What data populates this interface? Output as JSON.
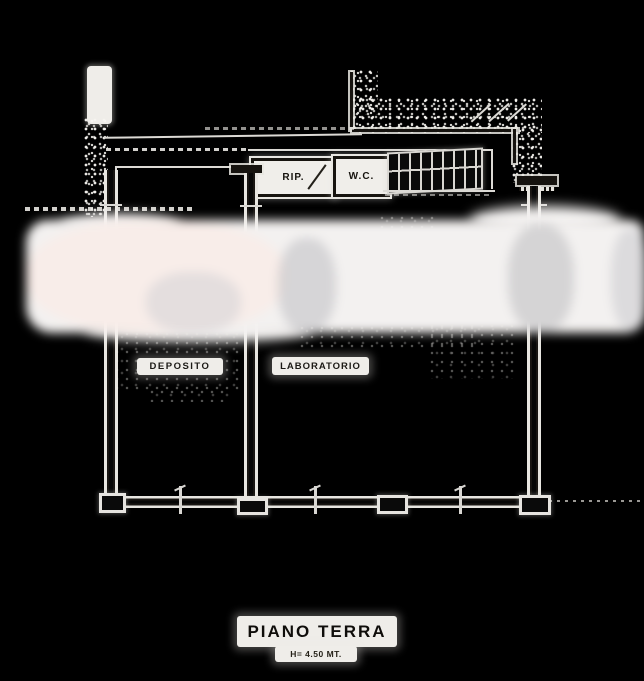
{
  "plan": {
    "rooms": {
      "rip": {
        "label": "RIP."
      },
      "wc": {
        "label": "W.C."
      },
      "deposito": {
        "label": "DEPOSITO"
      },
      "laboratorio": {
        "label": "LABORATORIO"
      }
    },
    "footer": {
      "title": "PIANO TERRA",
      "height_note": "H= 4.50 MT."
    },
    "colors": {
      "background": "#000000",
      "drawing_line": "#e8e6e1",
      "ink": "#17140f",
      "paper_patch": "#f0eeea",
      "redaction_band": "#f3f1f0"
    }
  }
}
